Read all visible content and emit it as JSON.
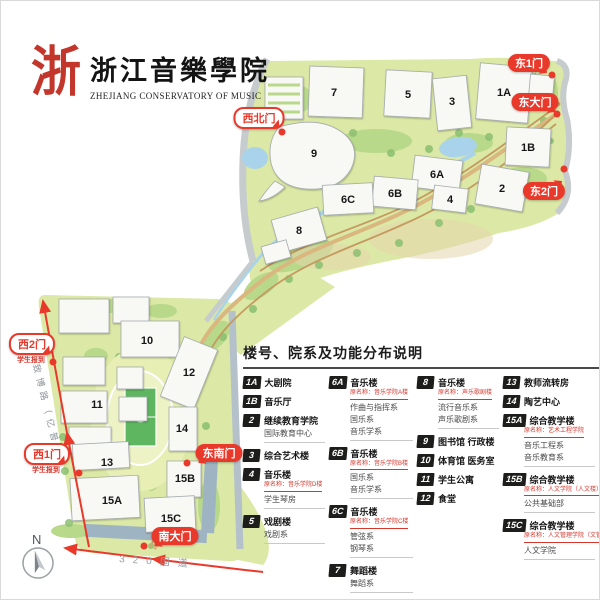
{
  "logo": {
    "mark": "浙",
    "title_cn": "浙江音樂學院",
    "title_en": "ZHEJIANG CONSERVATORY OF MUSIC"
  },
  "map": {
    "compass": "N",
    "roads": {
      "west": "致博路（亿普路）",
      "south": "320国道"
    },
    "building_labels": {
      "b7": "7",
      "b5": "5",
      "b3": "3",
      "b1A": "1A",
      "b9": "9",
      "b1B": "1B",
      "b2": "2",
      "b6A": "6A",
      "b4": "4",
      "b6B": "6B",
      "b6C": "6C",
      "b8": "8",
      "b10": "10",
      "b12": "12",
      "b11": "11",
      "b14": "14",
      "b13": "13",
      "b15A": "15A",
      "b15B": "15B",
      "b15C": "15C"
    },
    "gates": {
      "dong1": {
        "label": "东1门"
      },
      "dongda": {
        "label": "东大门"
      },
      "dong2": {
        "label": "东2门"
      },
      "xibei": {
        "label": "西北门"
      },
      "xi2": {
        "label": "西2门",
        "note": "学生报到"
      },
      "xi1": {
        "label": "西1门",
        "note": "学生报到"
      },
      "dongnan": {
        "label": "东南门"
      },
      "nanda": {
        "label": "南大门"
      }
    }
  },
  "legend": {
    "title": "楼号、院系及功能分布说明",
    "columns": [
      [
        {
          "num": "1A",
          "name": "大剧院"
        },
        {
          "num": "1B",
          "name": "音乐厅"
        },
        {
          "num": "2",
          "name": "继续教育学院",
          "depts": [
            "国际教育中心"
          ]
        },
        {
          "num": "3",
          "name": "综合艺术楼"
        },
        {
          "num": "4",
          "name": "音乐楼",
          "former": "原名称：音乐学院D楼",
          "depts": [
            "学生琴房"
          ]
        },
        {
          "num": "5",
          "name": "戏剧楼",
          "depts": [
            "戏剧系"
          ]
        }
      ],
      [
        {
          "num": "6A",
          "name": "音乐楼",
          "former": "原名称：音乐学院A楼",
          "depts": [
            "作曲与指挥系",
            "国乐系",
            "音乐学系"
          ]
        },
        {
          "num": "6B",
          "name": "音乐楼",
          "former": "原名称：音乐学院B楼",
          "depts": [
            "国乐系",
            "音乐学系"
          ]
        },
        {
          "num": "6C",
          "name": "音乐楼",
          "former": "原名称：音乐学院C楼",
          "depts": [
            "管弦系",
            "钢琴系"
          ]
        },
        {
          "num": "7",
          "name": "舞蹈楼",
          "depts": [
            "舞蹈系"
          ]
        }
      ],
      [
        {
          "num": "8",
          "name": "音乐楼",
          "former": "原名称：声乐歌剧楼",
          "depts": [
            "流行音乐系",
            "声乐歌剧系"
          ]
        },
        {
          "num": "9",
          "name": "图书馆 行政楼"
        },
        {
          "num": "10",
          "name": "体育馆 医务室"
        },
        {
          "num": "11",
          "name": "学生公寓"
        },
        {
          "num": "12",
          "name": "食堂"
        }
      ],
      [
        {
          "num": "13",
          "name": "教师流转房"
        },
        {
          "num": "14",
          "name": "陶艺中心"
        },
        {
          "num": "15A",
          "name": "综合教学楼",
          "former": "原名称：艺术工程学院",
          "depts": [
            "音乐工程系",
            "音乐教育系"
          ]
        },
        {
          "num": "15B",
          "name": "综合教学楼",
          "former": "原名称：人文学院（人文楼）",
          "depts": [
            "公共基础部"
          ]
        },
        {
          "num": "15C",
          "name": "综合教学楼",
          "former": "原名称：人文管理学院（文管楼）",
          "depts": [
            "人文学院"
          ]
        }
      ]
    ]
  },
  "colors": {
    "accent_red": "#e8392b",
    "campus_green": "#dbe8a6",
    "badge_black": "#1d1d1b",
    "water_blue": "#a9d3ea"
  }
}
